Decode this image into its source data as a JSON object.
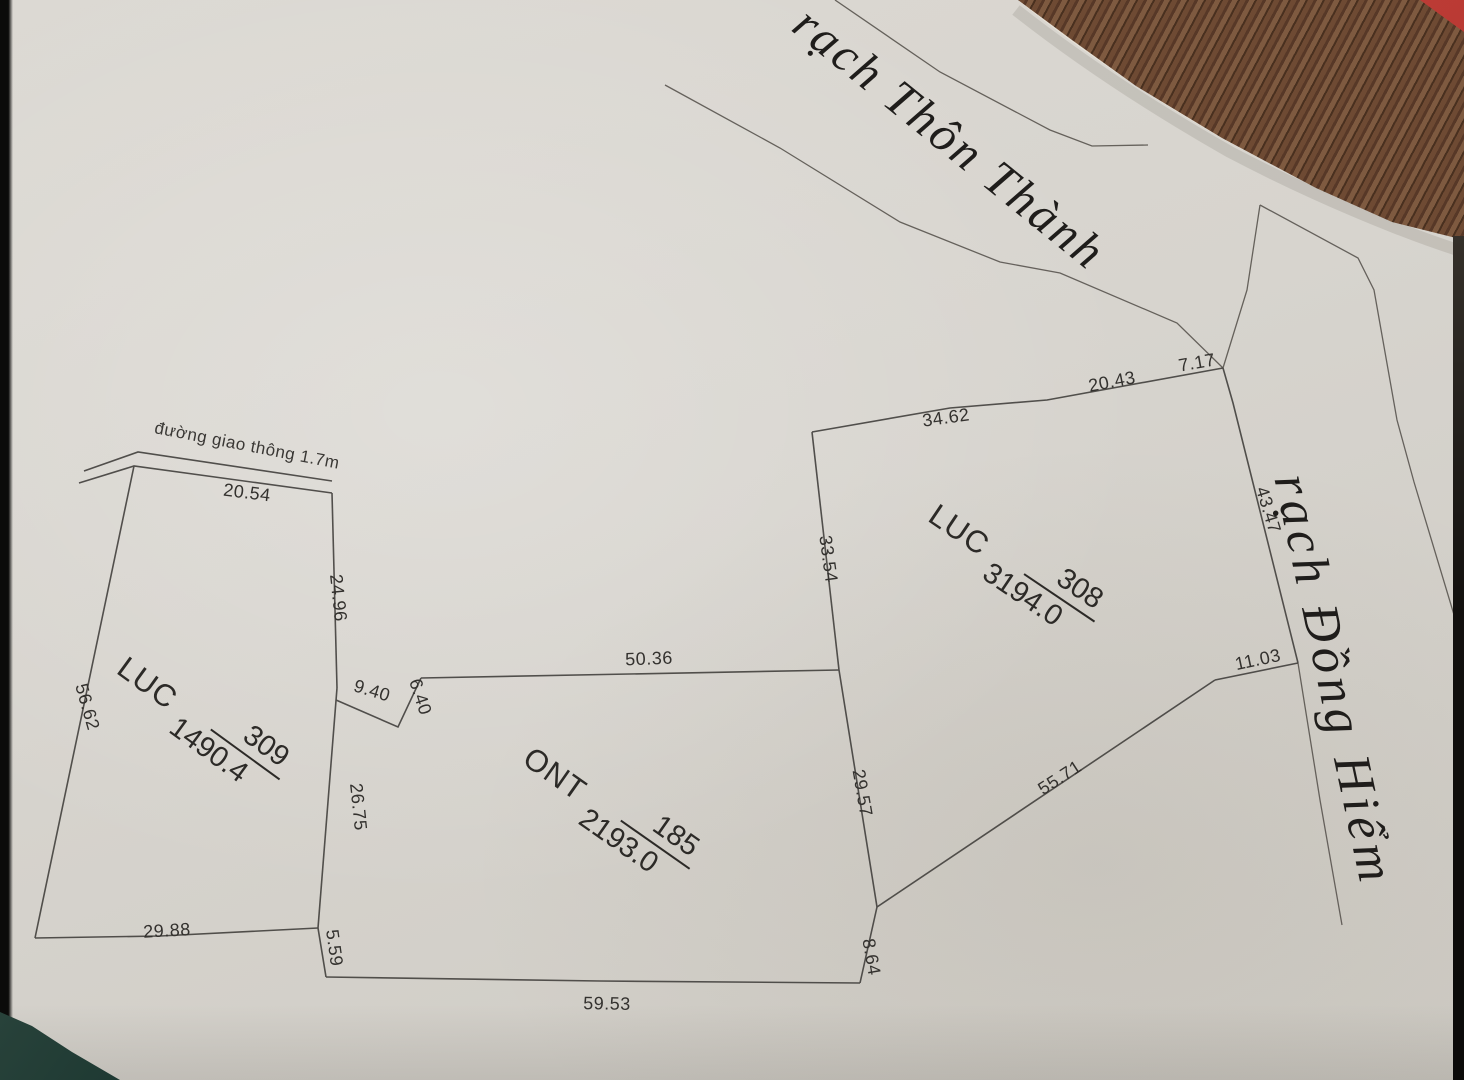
{
  "photo": {
    "streams": {
      "thon_thanh": "rạch Thôn Thành",
      "dong_hiem": "rạch Đồng Hiểm"
    },
    "road_label": "đường giao thông 1.7m",
    "parcels": [
      {
        "land_use": "LUC",
        "number": "309",
        "area": "1490.4"
      },
      {
        "land_use": "ONT",
        "number": "185",
        "area": "2193.0"
      },
      {
        "land_use": "LUC",
        "number": "308",
        "area": "3194.0"
      }
    ],
    "dims": {
      "road_front": "20.54",
      "p309_right_upper": "24.96",
      "p309_left": "56.62",
      "p309_right_lower": "26.75",
      "p309_bottom": "29.88",
      "notch_a": "9.40",
      "notch_b": "6.40",
      "p185_left_lower": "5.59",
      "p185_top": "50.36",
      "p185_right": "29.57",
      "p185_bottom": "59.53",
      "p185_se": "8.64",
      "p308_top_a": "34.62",
      "p308_top_b": "20.43",
      "p308_ne": "7.17",
      "p308_east": "43.47",
      "p308_se": "11.03",
      "p308_south": "55.71",
      "p308_west": "33.54"
    }
  }
}
